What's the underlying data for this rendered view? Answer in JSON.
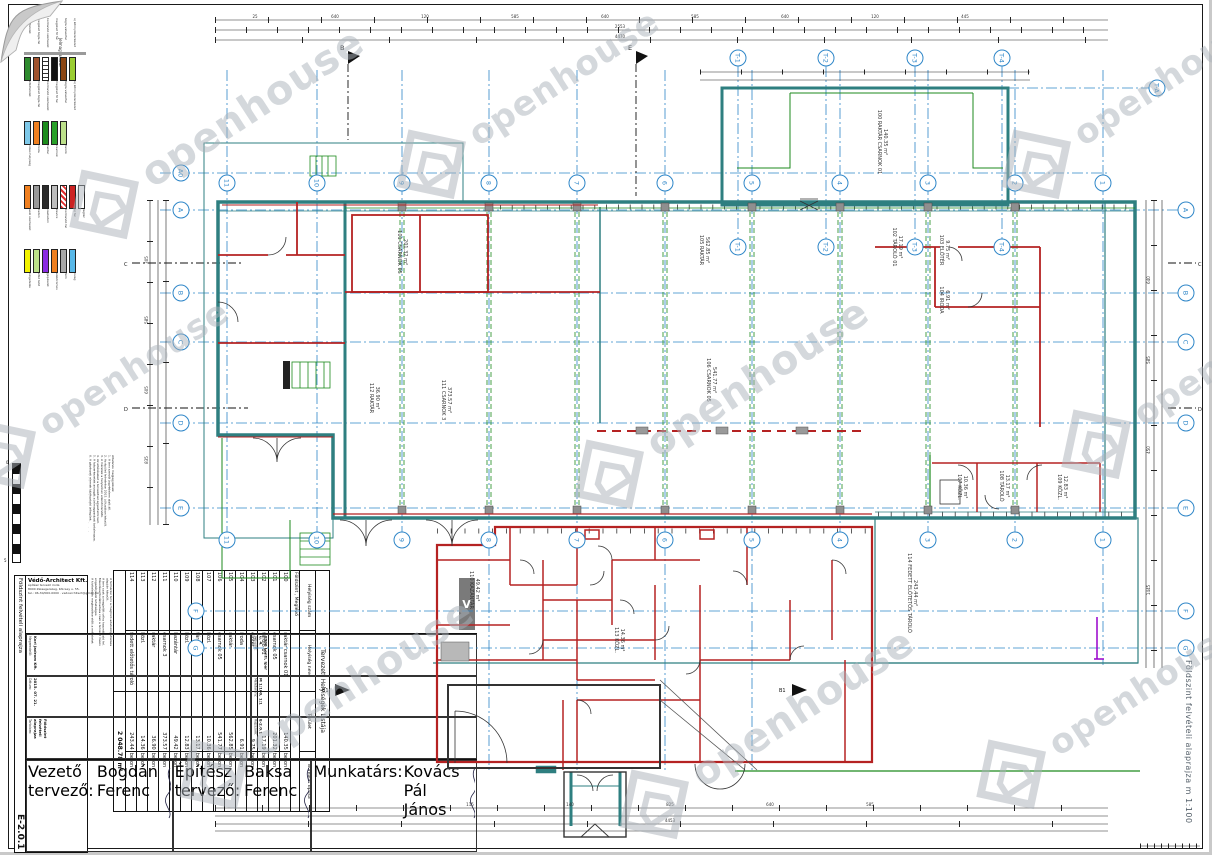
{
  "sheet": {
    "side_title": "Földszint felvételi alaprajza m 1:100",
    "drawing_number": "E-2.0.1",
    "scale": "M 1:100, 1:1",
    "date": "2015. 07. 21.",
    "project_title": "Földszint felvételi alaprajza"
  },
  "watermark": {
    "text": "openhouse"
  },
  "firm": {
    "name": "Védő-Architect Kft.",
    "logo_letter": "V",
    "lines": [
      "építész tervező iroda",
      "8900 Zalaegerszeg, Kölcsey u. 55.",
      "tel.: 06-30/000-0000 · vedoarchitect@gmail.com"
    ]
  },
  "title_block": {
    "fields": [
      {
        "label": "Megrendelő:",
        "value": "Kori Jadrom Kft."
      },
      {
        "label": "Helyszín:",
        "value": "8900 Lenti, Ipar u. 4."
      },
      {
        "label": "Dátum:",
        "value": "2015. 07. 21."
      },
      {
        "label": "Méretarány:",
        "value": "M 1:100, 1:1"
      },
      {
        "label": "Tartalom:",
        "value": "Földszint felvételi alaprajza"
      },
      {
        "label": "Rajzszám:",
        "value": "E-2.0.1"
      }
    ],
    "signers": [
      {
        "role": "Vezető tervező:",
        "name": "Bogdán Ferenc"
      },
      {
        "role": "Építész tervező:",
        "name": "Baksa Ferenc"
      },
      {
        "role": "Munkatárs:",
        "name": "Kovács Pál János"
      }
    ]
  },
  "legend": {
    "title": "Jelmagyarázat",
    "groups": [
      {
        "swatches": [
          {
            "c": "#2e8b2e",
            "label": "zöldfelület"
          },
          {
            "c": "#a0522d",
            "label": "meglévő tégla fal"
          },
          {
            "c": "#ffffff",
            "label": "bontandó szerkezet",
            "hatch": "dash"
          },
          {
            "c": "#111111",
            "label": "meglévő fő fal"
          },
          {
            "c": "#8b4513",
            "label": "tégla válaszfal"
          },
          {
            "c": "#9acd32",
            "label": "új könnyűszerkezet"
          }
        ]
      },
      {
        "swatches": [
          {
            "c": "#7ec8e8",
            "label": "vizes helyiség"
          },
          {
            "c": "#f08020",
            "label": "iroda"
          },
          {
            "c": "#1c8c1c",
            "label": "raktár"
          },
          {
            "c": "#28a028",
            "label": "csarnok"
          },
          {
            "c": "#bce08a",
            "label": "tároló"
          }
        ]
      },
      {
        "swatches": [
          {
            "c": "#f08020",
            "label": "acél szerkezet"
          },
          {
            "c": "#9a9a9a",
            "label": "beton"
          },
          {
            "c": "#2b2b2b",
            "label": "vasbeton"
          },
          {
            "c": "#bdbdbd",
            "label": "kavics"
          },
          {
            "c": "#e03030",
            "label": "bontandó fal",
            "hatch": "cross"
          },
          {
            "c": "#cc2222",
            "label": "új fal"
          },
          {
            "c": "#ffffff",
            "label": "légtér"
          }
        ]
      },
      {
        "swatches": [
          {
            "c": "#f2f200",
            "label": "szigetelés"
          },
          {
            "c": "#bce08a",
            "label": "zöld tető"
          },
          {
            "c": "#8a2be2",
            "label": "gépészet"
          },
          {
            "c": "#f08020",
            "label": "elektromos"
          },
          {
            "c": "#a8a8a8",
            "label": "fém"
          },
          {
            "c": "#58b8e8",
            "label": "üveg"
          }
        ]
      }
    ]
  },
  "notes": {
    "para1": [
      "Általános megjegyzések:",
      "1. A terv szerzői jogvédelem alatt áll.",
      "2. Az épület felmérése 2015. júliusában készült.",
      "3. A méretek a helyszínen ellenőrizendők.",
      "4. Az eltéréseket a tervezővel egyeztetni kell.",
      "5. A falszerkezetek anyagát a jelmagyarázat tartalmazza.",
      "6. A gépészeti elemek tájékoztató jellegűek.",
      "7. A terv az építési engedélyezési dokumentáció része.",
      "8. Minden méret cm-ben értendő."
    ],
    "para2": [
      "A felmérési terv a megbízó adatszolgáltatása",
      "alapján készült.",
      "A terv csak a megjelölt célra használható fel.",
      "Másolása, továbbadása csak a tervező írásos",
      "engedélyével lehetséges.",
      "A kivitelezés megkezdése előtt a méreteket",
      "a helyszínen egyeztetni szükséges."
    ]
  },
  "schedule": {
    "title": "Tervezett Helyiségek Listája",
    "headers": [
      "Helyiség szám",
      "Helyiség neve",
      "Terület",
      "Burkolat típusa"
    ],
    "section": "Földszint , Meglévő",
    "rows": [
      [
        "100",
        "raktár csarnok 01",
        "140.35",
        "beton"
      ],
      [
        "101",
        "csarnok 05",
        "201.32",
        "beton"
      ],
      [
        "102",
        "tároló 01",
        "17.19",
        "beton"
      ],
      [
        "103",
        "előtér",
        "9.75",
        "beton"
      ],
      [
        "104",
        "iroda",
        "6.91",
        "beton"
      ],
      [
        "105",
        "raktár",
        "562.85",
        "beton"
      ],
      [
        "106",
        "csarnok 05",
        "541.77",
        "beton"
      ],
      [
        "107",
        "közl.",
        "10.36",
        "beton"
      ],
      [
        "108",
        "tároló",
        "13.17",
        "beton"
      ],
      [
        "109",
        "közl.",
        "12.83",
        "beton"
      ],
      [
        "110",
        "kazántár",
        "49.42",
        "beton"
      ],
      [
        "111",
        "csarnok 3",
        "373.57",
        "beton"
      ],
      [
        "112",
        "raktár",
        "36.90",
        "beton"
      ],
      [
        "113",
        "közl.",
        "14.36",
        "beton"
      ],
      [
        "114",
        "fedett előtetős tároló",
        "243.44",
        "beton"
      ]
    ],
    "total": "2 048.78 m²"
  },
  "grid": {
    "h_left": [
      "A0",
      "A",
      "B",
      "C",
      "D",
      "E",
      "F",
      "G"
    ],
    "h_right": [
      "A",
      "B",
      "C",
      "D",
      "E",
      "F",
      "G"
    ],
    "v_labels": [
      "11",
      "10",
      "9",
      "8",
      "7",
      "6",
      "5",
      "4",
      "3",
      "2",
      "1"
    ],
    "t_labels": [
      "T-1",
      "T-2",
      "T-3",
      "T-4"
    ],
    "extra": "T-A"
  },
  "plan": {
    "section_markers": {
      "top1": "B",
      "top2": "E",
      "bottom": "B1",
      "cut1": "C",
      "cut2": "D"
    }
  },
  "dims": {
    "top": [
      "25",
      "640",
      "120",
      "585",
      "640",
      "585",
      "640",
      "120",
      "445"
    ],
    "top2": [
      "2553",
      "4470"
    ],
    "left": [
      "305",
      "585",
      "605",
      "835"
    ],
    "right": [
      "640",
      "585",
      "450",
      "1445"
    ],
    "bottom": [
      "115",
      "140",
      "825",
      "640",
      "585"
    ],
    "bottom2": "4453"
  }
}
